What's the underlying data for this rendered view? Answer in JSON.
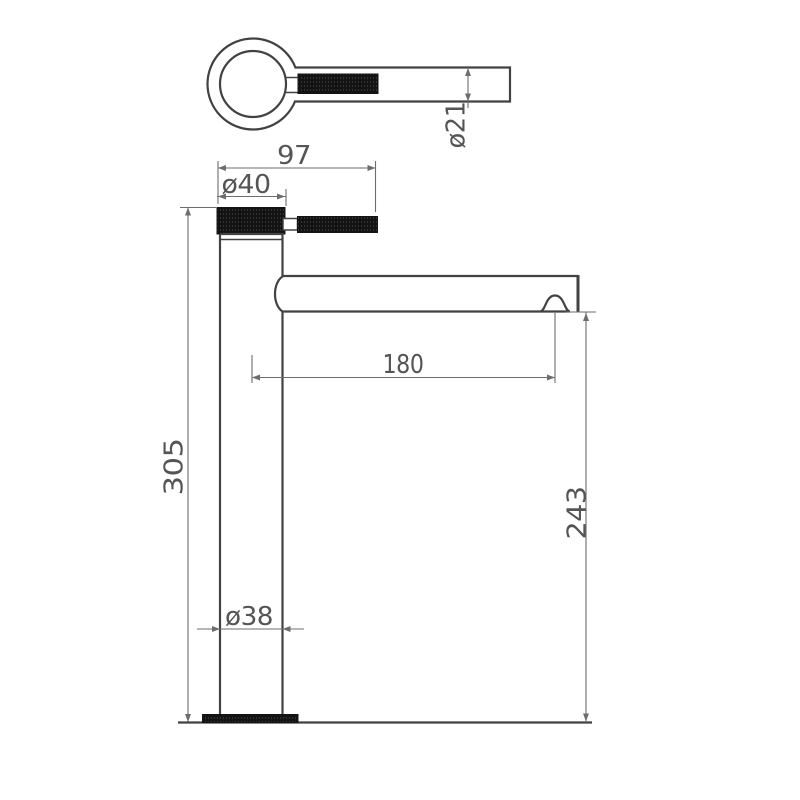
{
  "drawing": {
    "kind": "technical-dimension-drawing",
    "views": {
      "top_view": "tap-handle-top-view",
      "front_view": "tap-front-view"
    },
    "dimensions": {
      "top_tube_diameter": "ø21",
      "handle_length": "97",
      "cap_diameter": "ø40",
      "total_height": "305",
      "spout_reach": "180",
      "body_diameter": "ø38",
      "spout_height": "243"
    },
    "colors": {
      "outline": "#424242",
      "dim_line": "#6d6d6d",
      "text": "#555555",
      "fill_black": "#141414",
      "background": "#ffffff"
    }
  }
}
